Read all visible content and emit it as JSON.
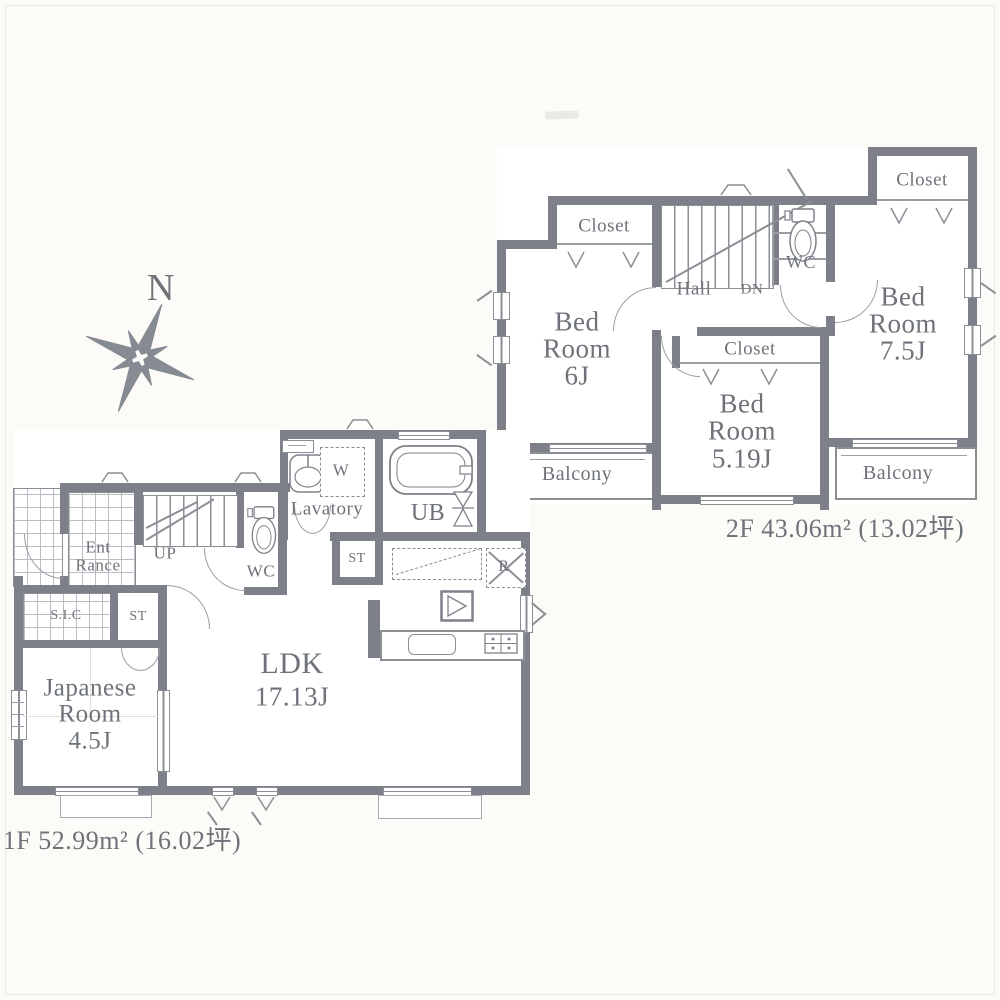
{
  "compass": {
    "label": "N"
  },
  "floor2": {
    "area_label": "2F 43.06m² (13.02坪)",
    "closet_left_label": "Closet",
    "closet_mid_label": "Closet",
    "closet_right_label": "Closet",
    "bedroom6": {
      "l1": "Bed",
      "l2": "Room",
      "l3": "6J"
    },
    "bedroom75": {
      "l1": "Bed",
      "l2": "Room",
      "l3": "7.5J"
    },
    "bedroom519": {
      "l1": "Bed",
      "l2": "Room",
      "l3": "5.19J"
    },
    "hall_label": "Hall",
    "dn_label": "DN",
    "wc_label": "WC",
    "balcony_left_label": "Balcony",
    "balcony_right_label": "Balcony"
  },
  "floor1": {
    "area_label": "1F 52.99m² (16.02坪)",
    "entrance": {
      "l1": "Ent",
      "l2": "Rance"
    },
    "up_label": "UP",
    "wc_label": "WC",
    "sic_label": "S.I.C",
    "st_entrance_label": "ST",
    "st_lavatory_label": "ST",
    "japanese_room": {
      "l1": "Japanese",
      "l2": "Room",
      "l3": "4.5J"
    },
    "ldk": {
      "l1": "LDK",
      "l2": "17.13J"
    },
    "lavatory_label": "Lavatory",
    "washer_label": "W",
    "ub_label": "UB",
    "fridge_label": "R"
  }
}
